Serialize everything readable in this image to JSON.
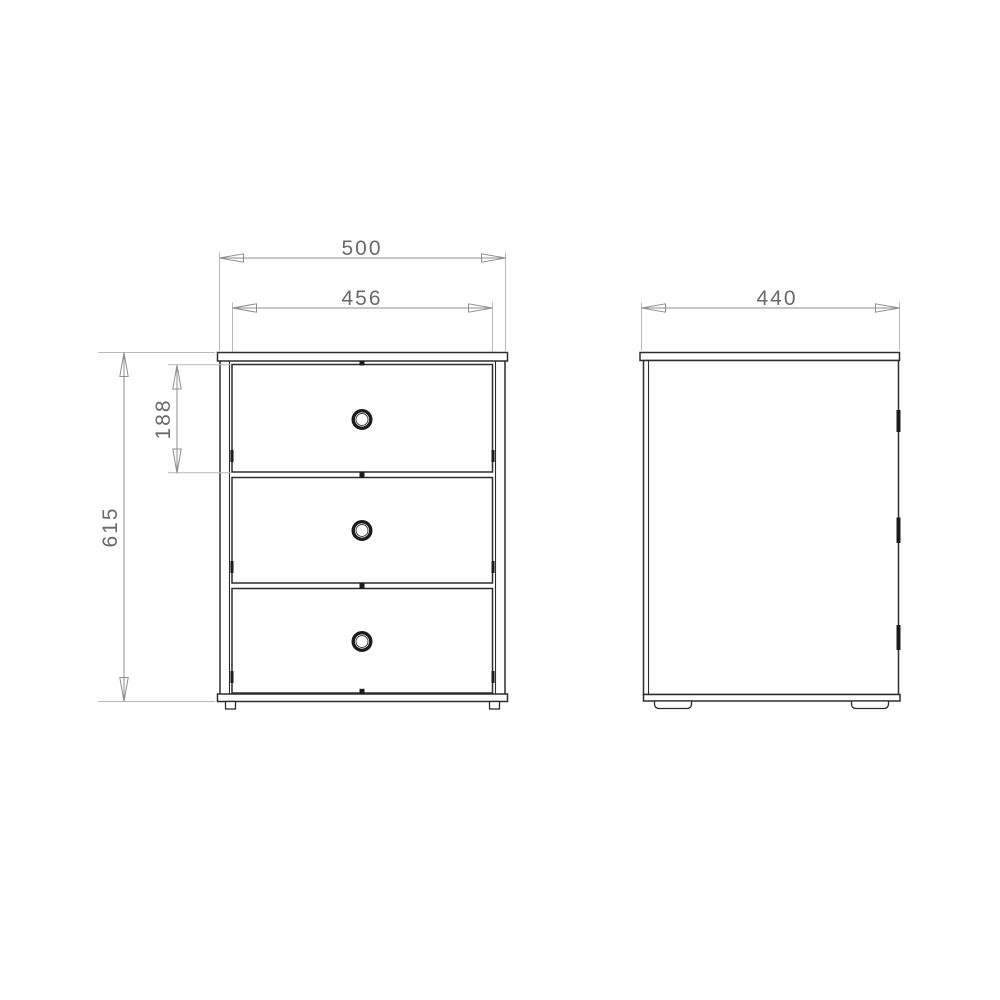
{
  "dimensions": {
    "front_overall_width": "500",
    "front_drawer_width": "456",
    "side_depth": "440",
    "front_overall_height": "615",
    "front_top_drawer_height": "188"
  },
  "icons": {
    "drawer_handle": "ring-pull",
    "arrowhead": "open-slender-triangle"
  },
  "colors": {
    "background": "#ffffff",
    "outline": "#2d2d2d",
    "dimension_line": "#8f8f8f",
    "extension_line": "#b9b9b9",
    "dimension_text": "#6a6a6a",
    "handle": "#1c1c1c"
  }
}
